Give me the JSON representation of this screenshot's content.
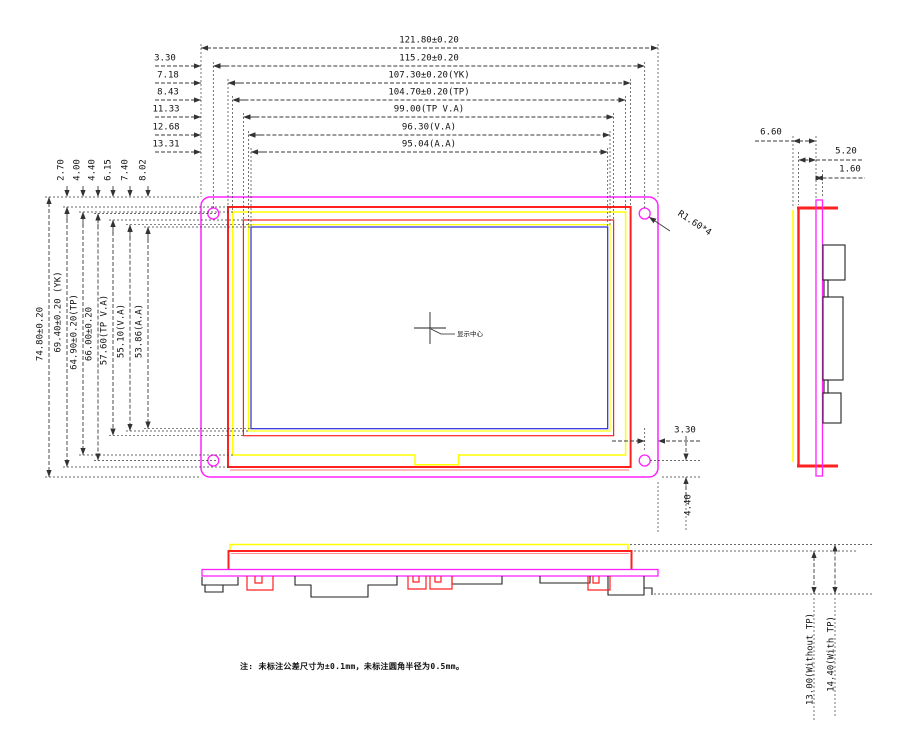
{
  "front": {
    "top_dims": [
      {
        "value": "121.80±0.20"
      },
      {
        "offset": "3.30",
        "value": "115.20±0.20"
      },
      {
        "offset": "7.18",
        "value": "107.30±0.20(YK)"
      },
      {
        "offset": "8.43",
        "value": "104.70±0.20(TP)"
      },
      {
        "offset": "11.33",
        "value": "99.00(TP V.A)"
      },
      {
        "offset": "12.68",
        "value": "96.30(V.A)"
      },
      {
        "offset": "13.31",
        "value": "95.04(A.A)"
      }
    ],
    "left_dims": [
      {
        "value": "74.80±0.20"
      },
      {
        "offset": "2.70",
        "value": "69.40±0.20 (YK)"
      },
      {
        "offset": "4.00",
        "value": "64.90±0.20(TP)"
      },
      {
        "offset": "4.40",
        "value": "66.00±0.20"
      },
      {
        "offset": "6.15",
        "value": "57.60(TP V.A)"
      },
      {
        "offset": "7.40",
        "value": "55.10(V.A)"
      },
      {
        "offset": "8.02",
        "value": "53.86(A.A)"
      }
    ],
    "corner_radius": "R1.60*4",
    "hole_offset_h": "3.30",
    "hole_offset_v": "4.40",
    "center_label": "显示中心"
  },
  "side": {
    "dims": [
      "6.60",
      "5.20",
      "1.60"
    ]
  },
  "bottom": {
    "dims": [
      "13.00(Without TP)",
      "14.40(With TP)"
    ]
  },
  "note": "注: 未标注公差尺寸为±0.1mm，未标注圆角半径为0.5mm。",
  "colors": {
    "outline": "#ff22ff",
    "frame": "#ff2020",
    "touch": "#ffff00",
    "active": "#2a2ad8",
    "dim": "#3a3a3a"
  }
}
